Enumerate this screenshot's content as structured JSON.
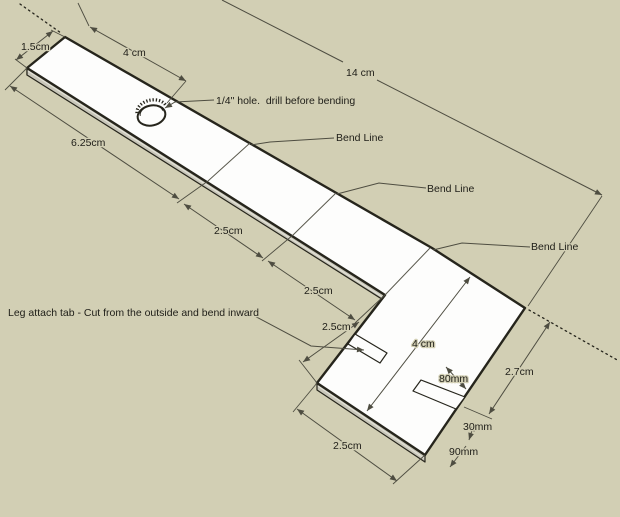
{
  "colors": {
    "bg": "#d2cfb4",
    "face": "#fdfdfc",
    "edge": "#26251c",
    "thickness": "#c8c6b9",
    "thickness_highlight": "#e2e1d7",
    "dim": "#4e4d41",
    "ink": "#21201a",
    "bend": "#5a594d"
  },
  "dimensions": {
    "end_width": "1.5cm",
    "hole_offset": "4 cm",
    "total_length": "14 cm",
    "lead_segment": "6.25cm",
    "segment_1": "2.5cm",
    "segment_2": "2.5cm",
    "foot_extension": "2.5cm",
    "foot_length": "2.5cm",
    "foot_width": "4 cm",
    "right_edge_offset": "2.7cm",
    "tab_length": "80mm",
    "tab_width": "30mm",
    "tab_corner_offset": "90mm"
  },
  "notes": {
    "hole": "1/4\" hole.  drill before bending",
    "bend_line_1": "Bend Line",
    "bend_line_2": "Bend Line",
    "bend_line_3": "Bend Line",
    "leg_tab": "Leg attach tab - Cut from the outside and bend inward"
  }
}
